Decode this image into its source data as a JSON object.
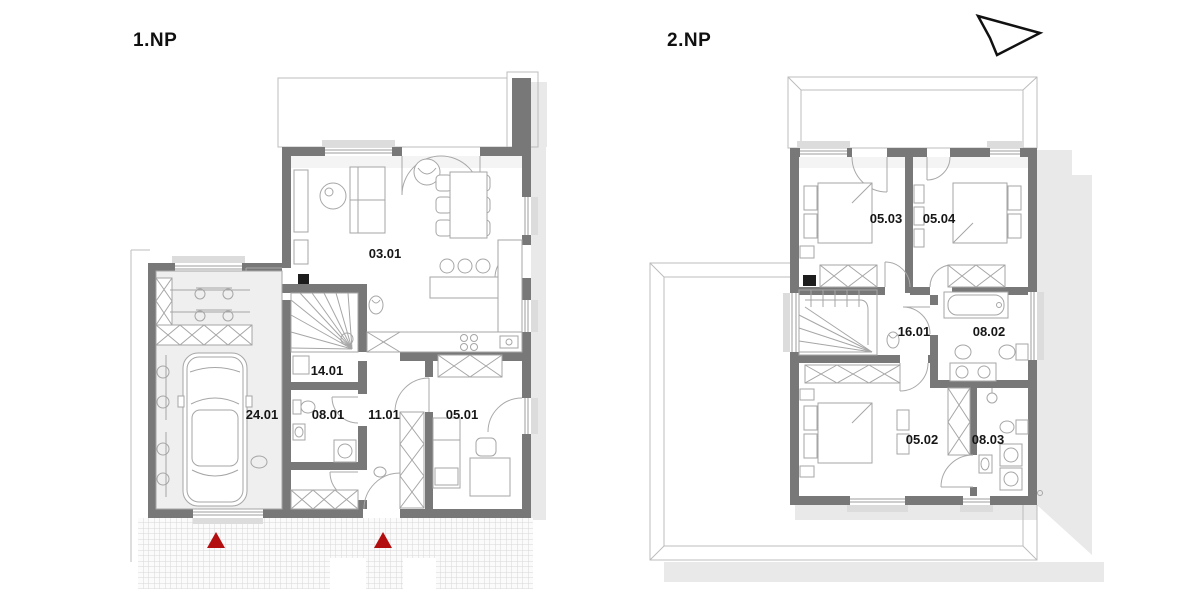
{
  "floors": [
    {
      "label": "1.NP",
      "rooms": [
        {
          "code": "03.01"
        },
        {
          "code": "14.01"
        },
        {
          "code": "24.01"
        },
        {
          "code": "08.01"
        },
        {
          "code": "11.01"
        },
        {
          "code": "05.01"
        }
      ],
      "entrance_marker_count": 2
    },
    {
      "label": "2.NP",
      "rooms": [
        {
          "code": "05.03"
        },
        {
          "code": "05.04"
        },
        {
          "code": "16.01"
        },
        {
          "code": "08.02"
        },
        {
          "code": "05.02"
        },
        {
          "code": "08.03"
        }
      ]
    }
  ],
  "icons": {
    "north_arrow": "north-arrow"
  },
  "markers": {
    "entrance_triangle_color": "#b30e10"
  },
  "colors": {
    "wall": "#787878",
    "furniture_line": "#a6a6a6",
    "shadow": "#e9e9e9",
    "paving_grid": "#d7d7d7",
    "label_text": "#161616"
  }
}
